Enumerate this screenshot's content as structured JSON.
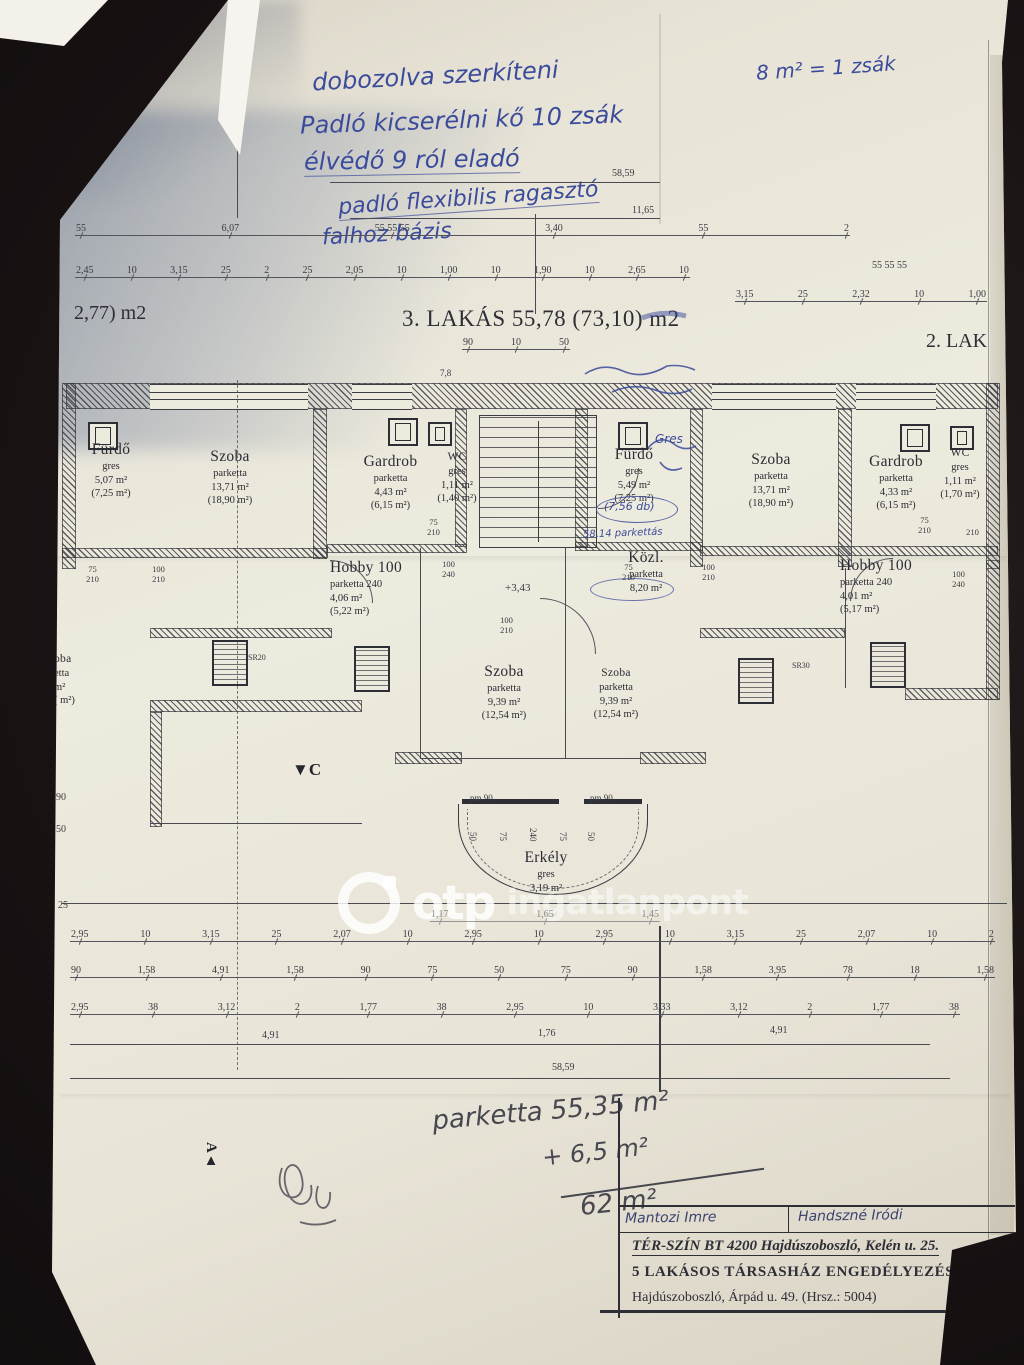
{
  "titles": {
    "left_partial": "2,77) m2",
    "center": "3. LAKÁS 55,78 (73,10) m2",
    "right_partial": "2. LAK"
  },
  "hand_top": {
    "right_note": "8 m² = 1 zsák",
    "l1": "dobozolva szerkíteni",
    "l2": "Padló kicserélni kő 10 zsák",
    "l3": "élvédő 9 ról eladó",
    "l4": "padló flexibilis ragasztó",
    "l5": "falhoz bázis"
  },
  "dims": {
    "v5859": "58,59",
    "v1165": "11,65",
    "rowA": [
      "55",
      "6,07",
      "55  55  55",
      "3,40",
      "55",
      "2"
    ],
    "rowA2": "55  55  55",
    "rowB": [
      "2,45",
      "10",
      "3,15",
      "25",
      "2",
      "25",
      "2,05",
      "10",
      "1,00",
      "10",
      "1,90",
      "10",
      "2,65",
      "10"
    ],
    "rowB2": [
      "3,15",
      "25",
      "2,32",
      "10",
      "1,00"
    ],
    "under_title": [
      "90",
      "10",
      "50"
    ],
    "v78": "7,8",
    "row0": [
      "1,17",
      "1,65",
      "1,45"
    ],
    "row1": [
      "2,95",
      "10",
      "3,15",
      "25",
      "2,07",
      "10",
      "2,95",
      "10",
      "2,95",
      "10",
      "3,15",
      "25",
      "2,07",
      "10",
      "2"
    ],
    "row2": [
      "90",
      "1,58",
      "4,91",
      "1,58",
      "90",
      "75",
      "50",
      "75",
      "90",
      "1,58",
      "3,95",
      "78",
      "18",
      "1,58"
    ],
    "row3": [
      "2,95",
      "38",
      "3,12",
      "2",
      "1,77",
      "38",
      "2,95",
      "10",
      "3,33",
      "3,12",
      "2",
      "1,77",
      "38"
    ],
    "row4": [
      "4,91",
      "1,76",
      "4,91"
    ],
    "total": "58,59",
    "left_side": [
      "90",
      "50",
      "25"
    ],
    "pm_left": "pm 90",
    "pm_right": "pm 90",
    "balcony_vert": [
      "50",
      "75",
      "240",
      "75",
      "50"
    ],
    "level": "+3,43",
    "sr20": "SR20",
    "sr30": "SR30",
    "side": [
      "75 210",
      "100 210",
      "75 210",
      "100 240",
      "100 210",
      "75 210",
      "100 210",
      "75 210",
      "210",
      "100 240"
    ]
  },
  "rooms": [
    {
      "lines": [
        "Fürdő",
        "gres",
        "5,07 m²",
        "(7,25 m²)"
      ]
    },
    {
      "lines": [
        "Szoba",
        "parketta",
        "13,71 m²",
        "(18,90 m²)"
      ]
    },
    {
      "lines": [
        "Gardrob",
        "parketta",
        "4,43 m²",
        "(6,15 m²)"
      ]
    },
    {
      "lines": [
        "WC",
        "gres",
        "1,11 m²",
        "(1,40 m²)"
      ]
    },
    {
      "lines": [
        "Fürdő",
        "gres",
        "5,49 m²",
        "(7,25 m²)"
      ]
    },
    {
      "lines": [
        "Szoba",
        "parketta",
        "13,71 m²",
        "(18,90 m²)"
      ]
    },
    {
      "lines": [
        "Gardrob",
        "parketta",
        "4,33 m²",
        "(6,15 m²)"
      ]
    },
    {
      "lines": [
        "WC",
        "gres",
        "1,11 m²",
        "(1,70 m²)"
      ]
    },
    {
      "lines": [
        "Hobby 100",
        "parketta 240",
        "4,06 m²",
        "(5,22 m²)"
      ]
    },
    {
      "lines": [
        "Közl.",
        "parketta",
        "8,20 m²"
      ]
    },
    {
      "lines": [
        "Szoba",
        "parketta",
        "9,39 m²",
        "(12,54 m²)"
      ]
    },
    {
      "lines": [
        "Szoba",
        "parketta",
        "9,39 m²",
        "(12,54 m²)"
      ]
    },
    {
      "lines": [
        "Hobby 100",
        "parketta 240",
        "4,01 m²",
        "(5,17 m²)"
      ]
    },
    {
      "lines": [
        "Erkély",
        "gres",
        "3,19 m²"
      ]
    },
    {
      "lines": [
        "oba",
        "etta",
        "m²",
        "( m²)"
      ]
    }
  ],
  "hand_plan": {
    "gres_note": "Gres",
    "circle_note": "(7,56 db)",
    "note_5814": "58,14 parkettás"
  },
  "watermark": {
    "brand": "otp",
    "suffix": "ingatlanpont"
  },
  "calc": {
    "l1": "parketta 55,35 m²",
    "l2": "+ 6,5 m²",
    "l3": "62 m²"
  },
  "title_block": {
    "sign1": "Mantozi Imre",
    "sign2": "Handszné Iródi",
    "firm": "TÉR-SZÍN BT 4200 Hajdúszoboszló, Kelén u. 25.",
    "project": "5 LAKÁSOS TÁRSASHÁZ ENGEDÉLYEZÉSI",
    "address": "Hajdúszoboszló, Árpád u. 49. (Hrsz.: 5004)"
  },
  "markers": {
    "top_left": "▲A",
    "bottom_left": "A▲",
    "section_c": "▼C"
  }
}
